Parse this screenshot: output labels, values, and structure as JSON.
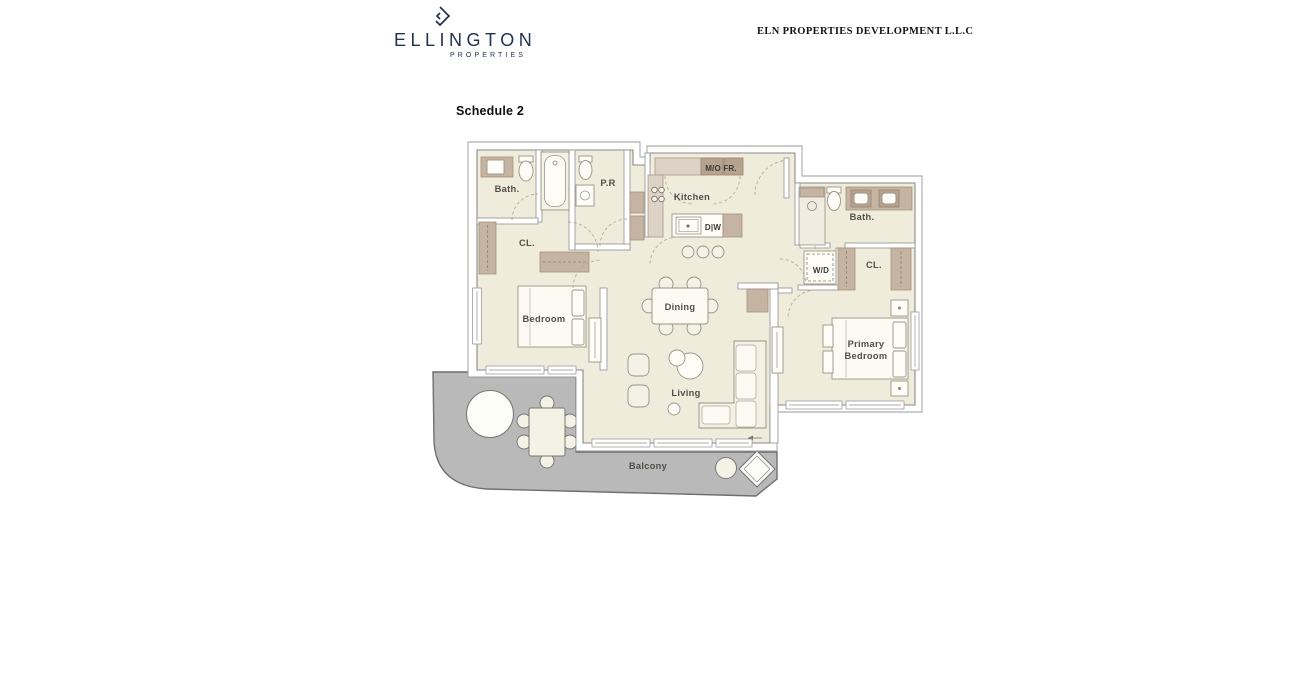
{
  "header": {
    "logo": {
      "name": "ELLINGTON",
      "sub": "PROPERTIES"
    },
    "company": "ELN PROPERTIES DEVELOPMENT L.L.C"
  },
  "document": {
    "schedule_title": "Schedule 2"
  },
  "floorplan": {
    "labels": {
      "bath_top": "Bath.",
      "powder_room": "P.R",
      "kitchen": "Kitchen",
      "microwave_fridge": "M/O FR.",
      "dishwasher": "D|W",
      "closet_left": "CL.",
      "bedroom": "Bedroom",
      "dining": "Dining",
      "washer_dryer": "W/D",
      "bath_right": "Bath.",
      "closet_right": "CL.",
      "primary_line1": "Primary",
      "primary_line2": "Bedroom",
      "living": "Living",
      "balcony": "Balcony"
    },
    "colors": {
      "floor": "#f0ecdc",
      "wall": "#8a8a8a",
      "cabinet": "#c6b4a3",
      "cabinet_dark": "#b6a28f",
      "balcony": "#b9b9b9",
      "navy": "#233250"
    }
  }
}
